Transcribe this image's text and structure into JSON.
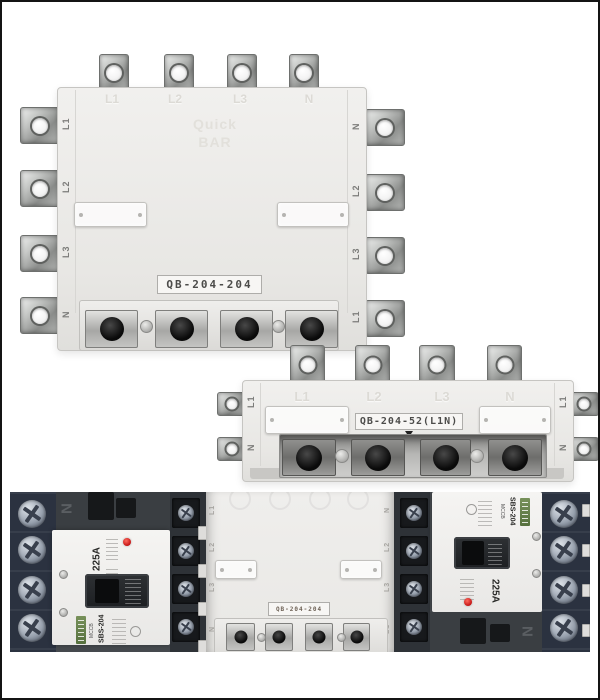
{
  "colors": {
    "background": "#ffffff",
    "frame_border": "#141414",
    "adapter_body": "#ecebe8",
    "embossed_text": "#dcdad5",
    "metal_lug": "#9fa19f",
    "socket_metal": "#b0b0ae",
    "screw_black": "#111111",
    "breaker_body": "#45494e",
    "terminal_block_navy": "#2b3240",
    "panel_white": "#f3f2f0",
    "indicator_red": "#cc1f1f",
    "plate_text": "#4c4c4a"
  },
  "top_adapter": {
    "model_label": "QB-204-204",
    "logo_line1": "Quick",
    "logo_line2": "BAR",
    "top_terminals": [
      "L1",
      "L2",
      "L3",
      "N"
    ],
    "left_terminals": [
      "L1",
      "L2",
      "L3",
      "N"
    ],
    "right_terminals": [
      "N",
      "L2",
      "L3",
      "L1"
    ]
  },
  "strip_adapter": {
    "model_label": "QB-204-52(L1N)",
    "top_terminals": [
      "L1",
      "L2",
      "L3",
      "N"
    ],
    "left_terminals": [
      "L1",
      "N"
    ],
    "right_terminals": [
      "L1",
      "N"
    ]
  },
  "photo": {
    "left_breaker": {
      "pole_marking": "N",
      "rating": "225A",
      "type_text": "MCCB",
      "model_text": "SBS-204"
    },
    "adapter": {
      "model_label": "QB-204-204",
      "left_terminals": [
        "L1",
        "L2",
        "L3",
        "N"
      ],
      "right_terminals": [
        "N",
        "L2",
        "L3",
        "L1"
      ]
    },
    "right_breaker": {
      "pole_marking": "N",
      "rating": "225A",
      "type_text": "MCCB",
      "model_text": "SBS-204"
    }
  }
}
